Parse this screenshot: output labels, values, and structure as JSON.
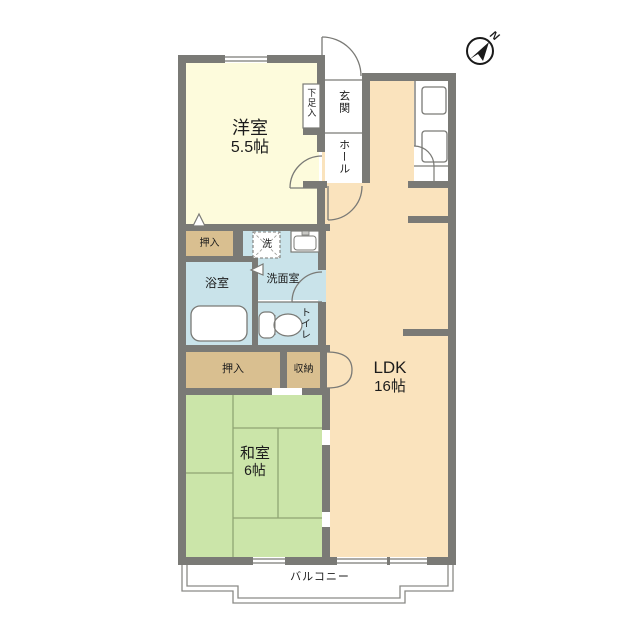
{
  "compass": {
    "label": "N"
  },
  "colors": {
    "wall": "#7a7a76",
    "line": "#7a7a76",
    "western_room": "#fdfbdc",
    "ldk": "#fae3bd",
    "japanese_room": "#cbe5a9",
    "closet": "#d9bf90",
    "wet_area": "#c9e3ea",
    "fixture_fill": "#ffffff",
    "balcony_line": "#8a8a86"
  },
  "rooms": {
    "western_room": {
      "name": "洋室",
      "size": "5.5帖"
    },
    "entrance": {
      "name": "玄関"
    },
    "hall": {
      "name": "ホール"
    },
    "shoe_cabinet": {
      "name": "下足入"
    },
    "closet_upper": {
      "name": "押入"
    },
    "washing_machine": {
      "name": "洗"
    },
    "washroom": {
      "name": "洗面室"
    },
    "bathroom": {
      "name": "浴室"
    },
    "toilet": {
      "name": "トイレ"
    },
    "closet_lower": {
      "name": "押入"
    },
    "storage": {
      "name": "収納"
    },
    "ldk": {
      "name": "LDK",
      "size": "16帖"
    },
    "japanese_room": {
      "name": "和室",
      "size": "6帖"
    },
    "balcony": {
      "name": "バルコニー"
    }
  }
}
